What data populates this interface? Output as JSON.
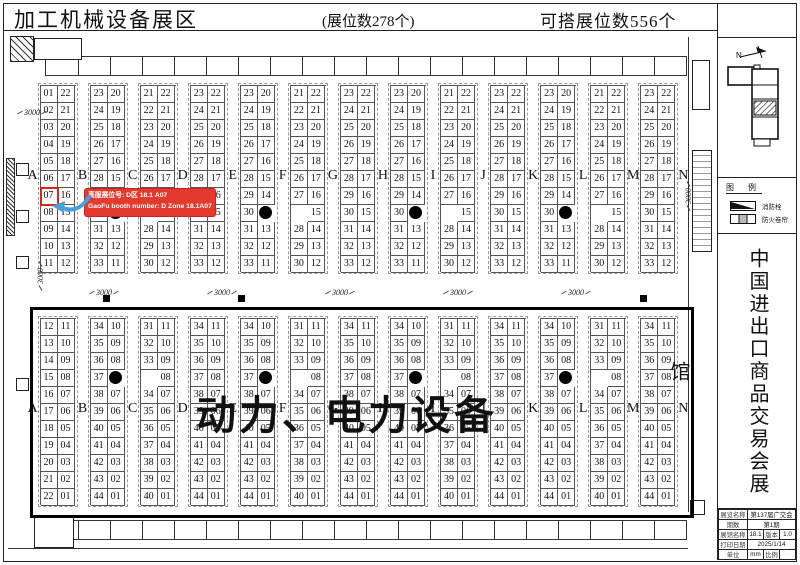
{
  "header": {
    "title": "加工机械设备展区",
    "booth_count": "(展位数278个)",
    "buildable_count": "可搭展位数556个"
  },
  "annotation": {
    "line1": "高服展位号: D区 18.1 A07",
    "line2": "GaoFu booth number: D Zone 18.1A07",
    "bg_color": "#e23b2e",
    "arrow_color": "#4a9fd8"
  },
  "center_label": "动力、电力设备",
  "letters": [
    "A",
    "B",
    "C",
    "D",
    "E",
    "F",
    "G",
    "H",
    "I",
    "J",
    "K",
    "L",
    "M",
    "N"
  ],
  "top_block": {
    "pairs": [
      {
        "left": [
          "01",
          "02",
          "03",
          "04",
          "05",
          "06",
          "07",
          "08",
          "09",
          "10",
          "11"
        ],
        "right": [
          "22",
          "21",
          "20",
          "19",
          "18",
          "17",
          "16",
          "15",
          "14",
          "13",
          "12"
        ],
        "dot": null,
        "highlight": {
          "side": "left",
          "row": 6
        }
      },
      {
        "left": [
          "23",
          "24",
          "25",
          "26",
          "27",
          "28",
          "29",
          "30",
          "31",
          "32",
          "33"
        ],
        "right": [
          "20",
          "19",
          "18",
          "17",
          "16",
          "15",
          "14",
          "",
          "13",
          "12",
          "11"
        ],
        "dot": {
          "side": "right",
          "row": 7
        },
        "highlight": null
      },
      {
        "left": [
          "21",
          "22",
          "23",
          "24",
          "25",
          "26",
          "27",
          "",
          "28",
          "29",
          "30"
        ],
        "right": [
          "22",
          "21",
          "20",
          "19",
          "18",
          "17",
          "16",
          "15",
          "14",
          "13",
          "12"
        ],
        "dot": null,
        "highlight": null
      },
      {
        "left": [
          "23",
          "24",
          "25",
          "26",
          "27",
          "28",
          "29",
          "30",
          "31",
          "32",
          "33"
        ],
        "right": [
          "22",
          "21",
          "20",
          "19",
          "18",
          "17",
          "16",
          "15",
          "14",
          "13",
          "12"
        ],
        "dot": null,
        "highlight": null
      },
      {
        "left": [
          "23",
          "24",
          "25",
          "26",
          "27",
          "28",
          "29",
          "30",
          "31",
          "32",
          "33"
        ],
        "right": [
          "20",
          "19",
          "18",
          "17",
          "16",
          "15",
          "14",
          "",
          "13",
          "12",
          "11"
        ],
        "dot": {
          "side": "right",
          "row": 7
        },
        "highlight": null
      },
      {
        "left": [
          "21",
          "22",
          "23",
          "24",
          "25",
          "26",
          "27",
          "",
          "28",
          "29",
          "30"
        ],
        "right": [
          "22",
          "21",
          "20",
          "19",
          "18",
          "17",
          "16",
          "15",
          "14",
          "13",
          "12"
        ],
        "dot": null,
        "highlight": null
      },
      {
        "left": [
          "23",
          "24",
          "25",
          "26",
          "27",
          "28",
          "29",
          "30",
          "31",
          "32",
          "33"
        ],
        "right": [
          "22",
          "21",
          "20",
          "19",
          "18",
          "17",
          "16",
          "15",
          "14",
          "13",
          "12"
        ],
        "dot": null,
        "highlight": null
      },
      {
        "left": [
          "23",
          "24",
          "25",
          "26",
          "27",
          "28",
          "29",
          "30",
          "31",
          "32",
          "33"
        ],
        "right": [
          "20",
          "19",
          "18",
          "17",
          "16",
          "15",
          "14",
          "",
          "13",
          "12",
          "11"
        ],
        "dot": {
          "side": "right",
          "row": 7
        },
        "highlight": null
      },
      {
        "left": [
          "21",
          "22",
          "23",
          "24",
          "25",
          "26",
          "27",
          "",
          "28",
          "29",
          "30"
        ],
        "right": [
          "22",
          "21",
          "20",
          "19",
          "18",
          "17",
          "16",
          "15",
          "14",
          "13",
          "12"
        ],
        "dot": null,
        "highlight": null
      },
      {
        "left": [
          "23",
          "24",
          "25",
          "26",
          "27",
          "28",
          "29",
          "30",
          "31",
          "32",
          "33"
        ],
        "right": [
          "22",
          "21",
          "20",
          "19",
          "18",
          "17",
          "16",
          "15",
          "14",
          "13",
          "12"
        ],
        "dot": null,
        "highlight": null
      },
      {
        "left": [
          "23",
          "24",
          "25",
          "26",
          "27",
          "28",
          "29",
          "30",
          "31",
          "32",
          "33"
        ],
        "right": [
          "20",
          "19",
          "18",
          "17",
          "16",
          "15",
          "14",
          "",
          "13",
          "12",
          "11"
        ],
        "dot": {
          "side": "right",
          "row": 7
        },
        "highlight": null
      },
      {
        "left": [
          "21",
          "22",
          "23",
          "24",
          "25",
          "26",
          "27",
          "",
          "28",
          "29",
          "30"
        ],
        "right": [
          "22",
          "21",
          "20",
          "19",
          "18",
          "17",
          "16",
          "15",
          "14",
          "13",
          "12"
        ],
        "dot": null,
        "highlight": null
      },
      {
        "left": [
          "23",
          "24",
          "25",
          "26",
          "27",
          "28",
          "29",
          "30",
          "31",
          "32",
          "33"
        ],
        "right": [
          "22",
          "21",
          "20",
          "19",
          "18",
          "17",
          "16",
          "15",
          "14",
          "13",
          "12"
        ],
        "dot": null,
        "highlight": null
      }
    ]
  },
  "bottom_block": {
    "pairs": [
      {
        "left": [
          "12",
          "13",
          "14",
          "15",
          "16",
          "17",
          "18",
          "19",
          "20",
          "21",
          "22"
        ],
        "right": [
          "11",
          "10",
          "09",
          "08",
          "07",
          "06",
          "05",
          "04",
          "03",
          "02",
          "01"
        ],
        "dot": null,
        "highlight": null
      },
      {
        "left": [
          "34",
          "35",
          "36",
          "37",
          "38",
          "39",
          "40",
          "41",
          "42",
          "43",
          "44"
        ],
        "right": [
          "10",
          "09",
          "08",
          "",
          "07",
          "06",
          "05",
          "04",
          "03",
          "02",
          "01"
        ],
        "dot": {
          "side": "right",
          "row": 3
        },
        "highlight": null
      },
      {
        "left": [
          "31",
          "32",
          "33",
          "",
          "34",
          "35",
          "36",
          "37",
          "38",
          "39",
          "40"
        ],
        "right": [
          "11",
          "10",
          "09",
          "08",
          "07",
          "06",
          "05",
          "04",
          "03",
          "02",
          "01"
        ],
        "dot": null,
        "highlight": null
      },
      {
        "left": [
          "34",
          "35",
          "36",
          "37",
          "38",
          "39",
          "40",
          "41",
          "42",
          "43",
          "44"
        ],
        "right": [
          "11",
          "10",
          "09",
          "08",
          "07",
          "06",
          "05",
          "04",
          "03",
          "02",
          "01"
        ],
        "dot": null,
        "highlight": null
      },
      {
        "left": [
          "34",
          "35",
          "36",
          "37",
          "38",
          "39",
          "40",
          "41",
          "42",
          "43",
          "44"
        ],
        "right": [
          "10",
          "09",
          "08",
          "",
          "07",
          "06",
          "05",
          "04",
          "03",
          "02",
          "01"
        ],
        "dot": {
          "side": "right",
          "row": 3
        },
        "highlight": null
      },
      {
        "left": [
          "31",
          "32",
          "33",
          "",
          "34",
          "35",
          "36",
          "37",
          "38",
          "39",
          "40"
        ],
        "right": [
          "11",
          "10",
          "09",
          "08",
          "07",
          "06",
          "05",
          "04",
          "03",
          "02",
          "01"
        ],
        "dot": null,
        "highlight": null
      },
      {
        "left": [
          "34",
          "35",
          "36",
          "37",
          "38",
          "39",
          "40",
          "41",
          "42",
          "43",
          "44"
        ],
        "right": [
          "11",
          "10",
          "09",
          "08",
          "07",
          "06",
          "05",
          "04",
          "03",
          "02",
          "01"
        ],
        "dot": null,
        "highlight": null
      },
      {
        "left": [
          "34",
          "35",
          "36",
          "37",
          "38",
          "39",
          "40",
          "41",
          "42",
          "43",
          "44"
        ],
        "right": [
          "10",
          "09",
          "08",
          "",
          "07",
          "06",
          "05",
          "04",
          "03",
          "02",
          "01"
        ],
        "dot": {
          "side": "right",
          "row": 3
        },
        "highlight": null
      },
      {
        "left": [
          "31",
          "32",
          "33",
          "",
          "34",
          "35",
          "36",
          "37",
          "38",
          "39",
          "40"
        ],
        "right": [
          "11",
          "10",
          "09",
          "08",
          "07",
          "06",
          "05",
          "04",
          "03",
          "02",
          "01"
        ],
        "dot": null,
        "highlight": null
      },
      {
        "left": [
          "34",
          "35",
          "36",
          "37",
          "38",
          "39",
          "40",
          "41",
          "42",
          "43",
          "44"
        ],
        "right": [
          "11",
          "10",
          "09",
          "08",
          "07",
          "06",
          "05",
          "04",
          "03",
          "02",
          "01"
        ],
        "dot": null,
        "highlight": null
      },
      {
        "left": [
          "34",
          "35",
          "36",
          "37",
          "38",
          "39",
          "40",
          "41",
          "42",
          "43",
          "44"
        ],
        "right": [
          "10",
          "09",
          "08",
          "",
          "07",
          "06",
          "05",
          "04",
          "03",
          "02",
          "01"
        ],
        "dot": {
          "side": "right",
          "row": 3
        },
        "highlight": null
      },
      {
        "left": [
          "31",
          "32",
          "33",
          "",
          "34",
          "35",
          "36",
          "37",
          "38",
          "39",
          "40"
        ],
        "right": [
          "11",
          "10",
          "09",
          "08",
          "07",
          "06",
          "05",
          "04",
          "03",
          "02",
          "01"
        ],
        "dot": null,
        "highlight": null
      },
      {
        "left": [
          "34",
          "35",
          "36",
          "37",
          "38",
          "39",
          "40",
          "41",
          "42",
          "43",
          "44"
        ],
        "right": [
          "11",
          "10",
          "09",
          "08",
          "07",
          "06",
          "05",
          "04",
          "03",
          "02",
          "01"
        ],
        "dot": null,
        "highlight": null
      }
    ]
  },
  "dimensions": {
    "strip_labels": [
      "3000",
      "3000",
      "3000",
      "3000",
      "3000"
    ],
    "left_top": "3000",
    "left_bottom": "3000",
    "right": "3000"
  },
  "sidebar": {
    "north_label": "N",
    "legend": {
      "title": "图 例",
      "items": [
        {
          "label": "消防栓"
        },
        {
          "label": "防火卷帘"
        }
      ]
    },
    "vertical_title": "中国进出口商品交易会展馆",
    "titleblock": {
      "rows": [
        {
          "label": "展览名称",
          "value": "第137届广交会"
        },
        {
          "label": "期数",
          "value": "第1期"
        },
        {
          "label": "展馆名称",
          "value": "18.1",
          "label2": "版本",
          "value2": "1.0"
        },
        {
          "label": "打印日期",
          "value": "2025/1/14"
        },
        {
          "label": "单位",
          "value": "mm",
          "label2": "比例",
          "value2": ""
        }
      ]
    }
  }
}
